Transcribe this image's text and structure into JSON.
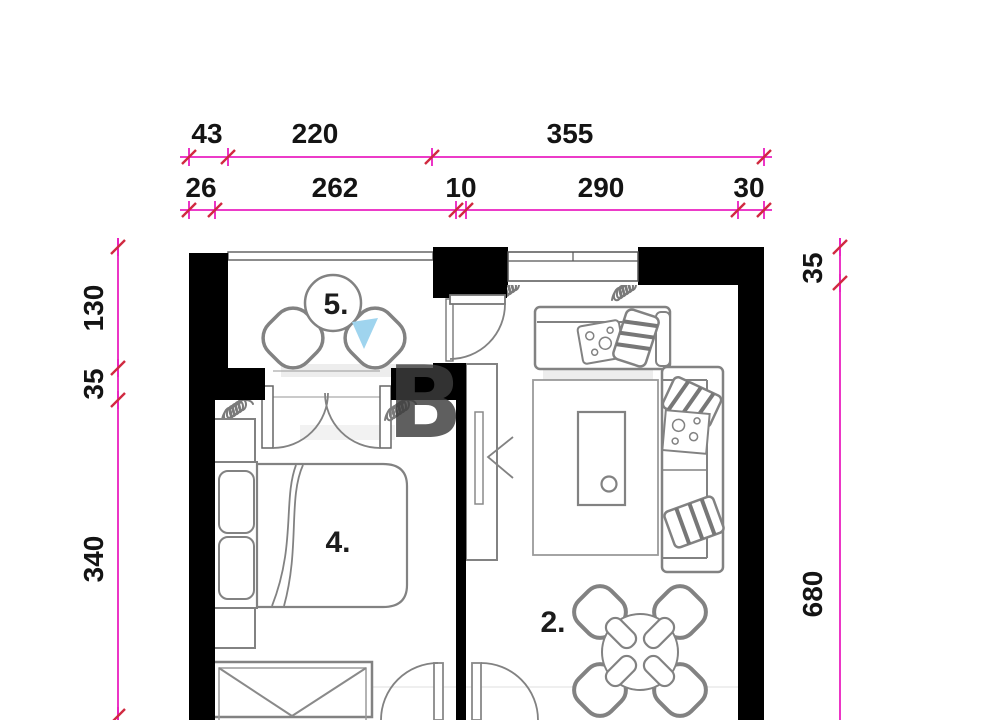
{
  "title": "Apartment floor plan with dimensions",
  "colors": {
    "dimension_line": "#ea1fc0",
    "tick_slash": "#d02a40",
    "wall": "#000000",
    "furniture": "#828282",
    "watermark_blue": "#9fd4ee",
    "watermark_gray": "#3d3d3d"
  },
  "dims": {
    "top_outer": [
      "43",
      "220",
      "355"
    ],
    "top_inner": [
      "26",
      "262",
      "10",
      "290",
      "30"
    ],
    "left": [
      "130",
      "35",
      "340"
    ],
    "left_partial": "0",
    "right": [
      "35",
      "680"
    ]
  },
  "rooms": {
    "balcony": "5.",
    "bedroom": "4.",
    "living": "2."
  },
  "watermark": {
    "letter": "B"
  }
}
